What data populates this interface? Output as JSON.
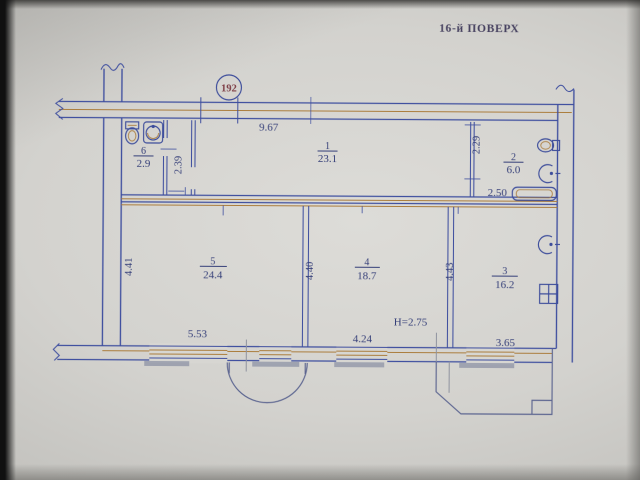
{
  "photo": {
    "title": "16-й ПОВЕРХ",
    "apartment_badge": "192"
  },
  "rooms": [
    {
      "number": "1",
      "area": "23.1"
    },
    {
      "number": "2",
      "area": "6.0"
    },
    {
      "number": "3",
      "area": "16.2"
    },
    {
      "number": "4",
      "area": "18.7"
    },
    {
      "number": "5",
      "area": "24.4"
    },
    {
      "number": "6",
      "area": "2.9"
    }
  ],
  "dimensions": {
    "hall_top_width": "9.67",
    "vestibule_depth": "2.39",
    "bathroom_depth": "2.29",
    "bathroom_width": "2.50",
    "room5_depth": "4.41",
    "room4_depth_left": "4.40",
    "room4_depth_right": "4.43",
    "room5_width": "5.53",
    "room4_width": "4.24",
    "room3_width": "3.65",
    "ceiling_height": "H=2.75"
  },
  "icons": [
    "toilet-icon",
    "washbasin-icon",
    "toilet-icon",
    "washbasin-icon",
    "bathtub-icon",
    "kitchen-sink-icon",
    "stove-icon"
  ],
  "colors": {
    "wall_blue": "#3f4f9f",
    "wall_tan": "#ab7d3d",
    "ink_navy": "#343e78",
    "badge_red": "#7d3d45",
    "paper": "#d7d6d2"
  }
}
